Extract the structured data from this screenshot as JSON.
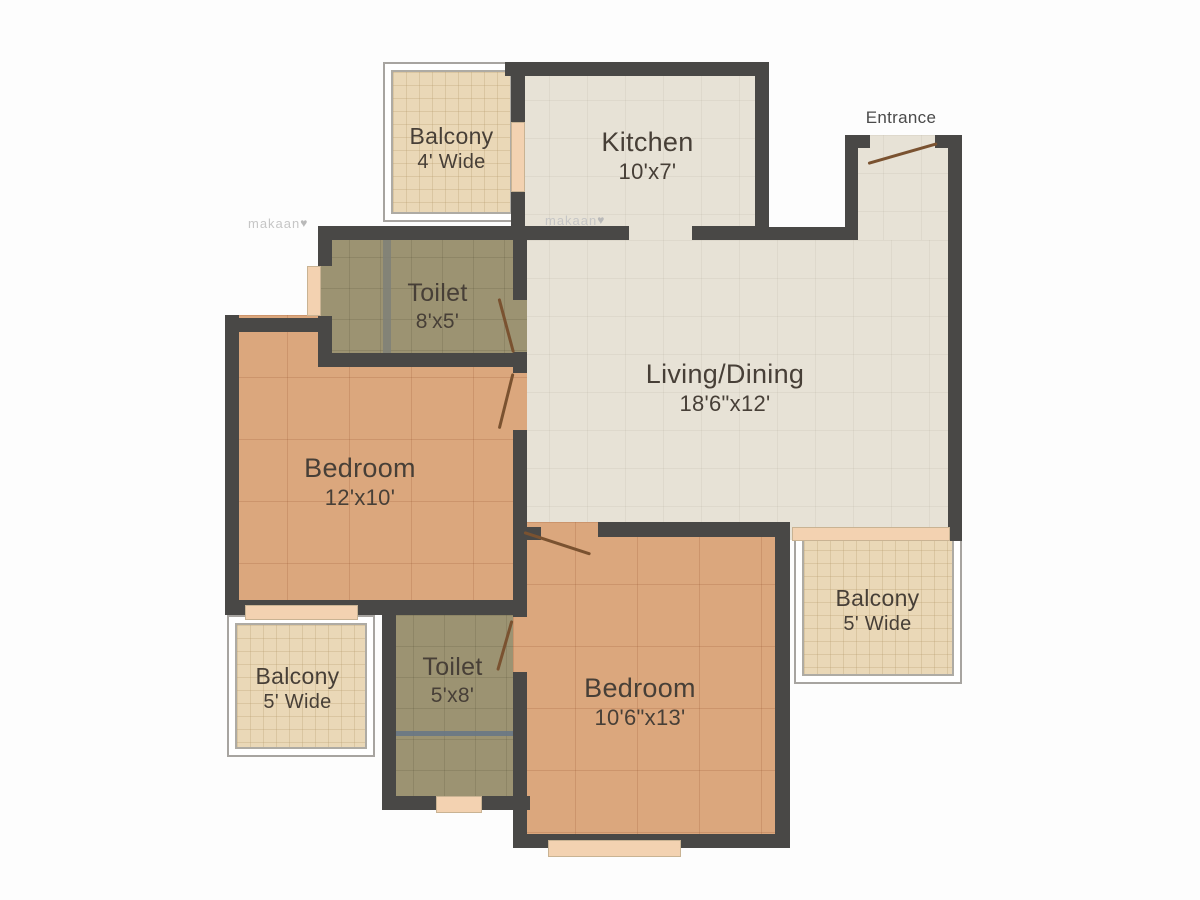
{
  "title": "Apartment floor plan",
  "rooms": [
    {
      "id": "balcony-top-left",
      "name": "Balcony",
      "size": "4' Wide"
    },
    {
      "id": "kitchen",
      "name": "Kitchen",
      "size": "10'x7'"
    },
    {
      "id": "toilet-upper",
      "name": "Toilet",
      "size": "8'x5'"
    },
    {
      "id": "living-dining",
      "name": "Living/Dining",
      "size": "18'6\"x12'"
    },
    {
      "id": "bedroom-left",
      "name": "Bedroom",
      "size": "12'x10'"
    },
    {
      "id": "balcony-bottom-left",
      "name": "Balcony",
      "size": "5' Wide"
    },
    {
      "id": "toilet-lower",
      "name": "Toilet",
      "size": "5'x8'"
    },
    {
      "id": "bedroom-bottom",
      "name": "Bedroom",
      "size": "10'6\"x13'"
    },
    {
      "id": "balcony-right",
      "name": "Balcony",
      "size": "5' Wide"
    }
  ],
  "entrance": {
    "label": "Entrance"
  },
  "watermark": {
    "text": "makaan",
    "heart": "♥"
  },
  "colors": {
    "wall": "#494846",
    "room_floor": "#e7e2d6",
    "bedroom_floor": "#dba77d",
    "toilet_floor": "#9c9372",
    "balcony_floor": "#ead8b7",
    "door_leaf": "#7a5230",
    "window": "#f3d2b1",
    "label_text": "#473f37",
    "watermark_text": "#c6c6c6"
  }
}
